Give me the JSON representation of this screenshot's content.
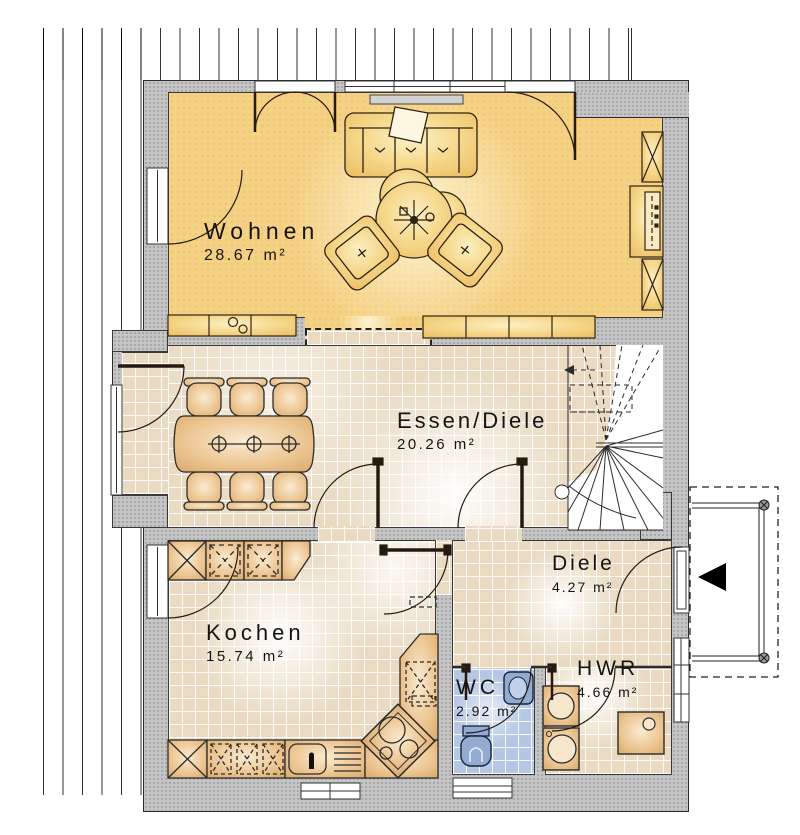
{
  "rooms": [
    {
      "id": "wohnen",
      "name": "Wohnen",
      "area": "28.67 m²"
    },
    {
      "id": "essen-diele",
      "name": "Essen/Diele",
      "area": "20.26 m²"
    },
    {
      "id": "kochen",
      "name": "Kochen",
      "area": "15.74 m²"
    },
    {
      "id": "diele",
      "name": "Diele",
      "area": "4.27 m²"
    },
    {
      "id": "wc",
      "name": "WC",
      "area": "2.92 m²"
    },
    {
      "id": "hwr",
      "name": "HWR",
      "area": "4.66 m²"
    }
  ],
  "icons": {
    "entrance_arrow": "entrance-direction-arrow"
  },
  "colors": {
    "wall": "#c5c5c5",
    "wohnen_floor": "#f5d184",
    "tile_floor": "#e9dac1",
    "wc_tile": "#b6c7e3",
    "wood_furniture": "#e0b176",
    "upholstery": "#f3d488",
    "wc_fixture": "#93abd0",
    "line": "#1c1c1c"
  }
}
